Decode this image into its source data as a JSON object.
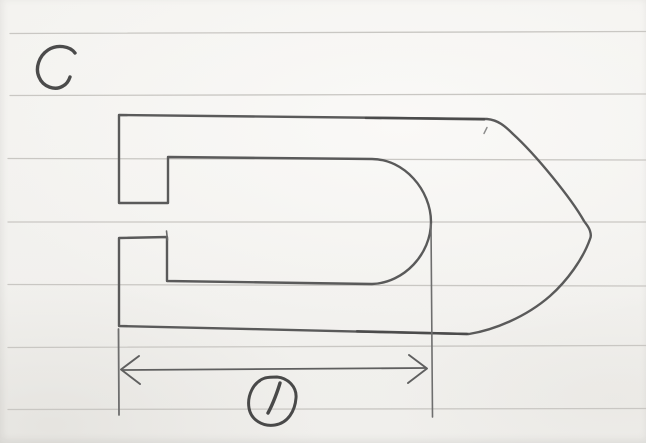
{
  "labels": {
    "part_letter": "C",
    "dimension_value": "1"
  },
  "colors": {
    "paper": "#f4f3f0",
    "rule": "#c9c7c3",
    "pencil": "#5a5a5a",
    "pencil_dark": "#4a4a4a",
    "pencil_light": "#8a8a8a"
  },
  "rules": {
    "r0": "M 10 33.5 L 646 31.5",
    "r1": "M 10 95.5 L 646 94",
    "r2": "M 8 158.5 L 646 160",
    "r3": "M 8 222 L 646 222",
    "r4": "M 8 284.5 L 646 286",
    "r5": "M 8 347.5 L 646 345.5",
    "r6": "M 8 409.5 L 646 408.5"
  },
  "sketch": {
    "outline_path": "M 119 115 C 250 116 380 117.5 487 119 C 498 120 505 126 513 134 C 536 155 571 198 584 221 C 586 224 589 227 590 231 C 591 234 591 237 590 239 C 583 259 567 281 550 296 C 526 317 494 330 469 334 C 340 331.5 200 327.5 119 326 L 119 238 L 167 237 L 167 281 L 372 284 C 404 283 431 254 431 222 C 431 190 404 159 372 159 L 168 157 L 168 203 L 119 203 Z",
    "overstroke_top_path": "M 366 117.8 L 484 119.3",
    "overstroke_bottom_path": "M 357 331.3 L 467 334",
    "prong_overshoot_path": "M 166.5 231 L 167.5 240",
    "stray_mark_path": "M 487 127.5 C 486 129.5 485 131.5 484 133.5",
    "extension_left_path": "M 118.5 329 L 119 415",
    "extension_right_path": "M 431 224 L 432.5 417",
    "dimension_line_path": "M 123 370 L 425 368",
    "arrowhead_left_path": "M 139 356 L 121 369.5 L 140 384",
    "arrowhead_right_path": "M 409 355 L 427 368.5 L 408 383",
    "letter_c_path": "M 75 53 C 70 46 57 44 48 50 C 39 56 35 68 39 77 C 43 87 55 91 63 86 C 67 84 69 80 70 77",
    "dim_circle_path": "M 277 377 C 288 378 297 387 296 398 C 295 411 288 423 275 425 C 263 427 251 420 249 408 C 247 396 253 382 265 378 C 269 377 273 377 277 377 Z",
    "dim_digit_path": "M 280 383 C 278 390 273 404 268 413"
  }
}
